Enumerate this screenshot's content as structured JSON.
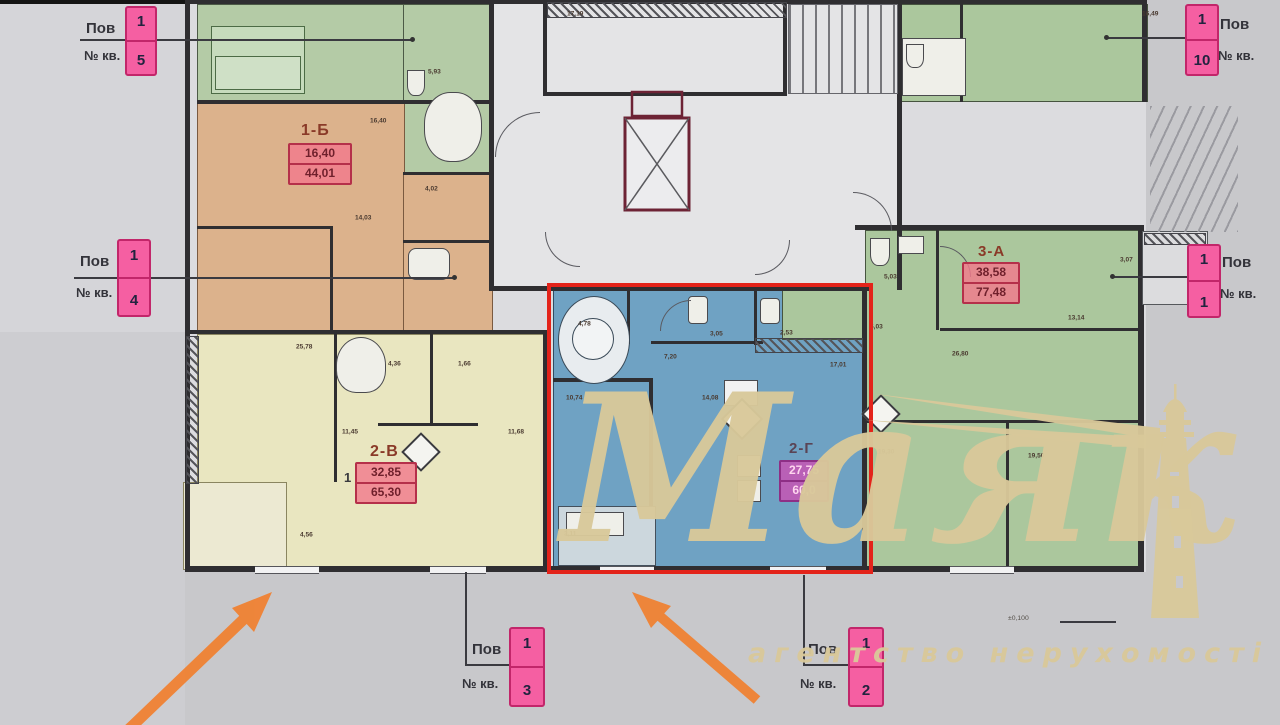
{
  "labels": {
    "pov": "Пов",
    "kv": "№ кв."
  },
  "floor_tags": [
    {
      "floor": "1",
      "apt": "5"
    },
    {
      "floor": "1",
      "apt": "4"
    },
    {
      "floor": "1",
      "apt": "10"
    },
    {
      "floor": "1",
      "apt": "1"
    },
    {
      "floor": "1",
      "apt": "3"
    },
    {
      "floor": "1",
      "apt": "2"
    }
  ],
  "apartments": [
    {
      "code": "1-Б",
      "living": "16,40",
      "total": "44,01"
    },
    {
      "code": "2-В",
      "living": "32,85",
      "total": "65,30"
    },
    {
      "code": "2-Г",
      "living": "27,75",
      "total": "60,0"
    },
    {
      "code": "3-А",
      "living": "38,58",
      "total": "77,48"
    }
  ],
  "extra": {
    "one": "1",
    "level": "±0,100"
  },
  "dims": [
    {
      "t": "17,19",
      "x": 567,
      "y": 10
    },
    {
      "t": "16,49",
      "x": 1142,
      "y": 10
    },
    {
      "t": "5,93",
      "x": 428,
      "y": 68
    },
    {
      "t": "16,40",
      "x": 370,
      "y": 117
    },
    {
      "t": "4,02",
      "x": 425,
      "y": 185
    },
    {
      "t": "14,03",
      "x": 355,
      "y": 214
    },
    {
      "t": "25,78",
      "x": 296,
      "y": 343
    },
    {
      "t": "4,36",
      "x": 388,
      "y": 360
    },
    {
      "t": "1,66",
      "x": 458,
      "y": 360
    },
    {
      "t": "11,45",
      "x": 342,
      "y": 428
    },
    {
      "t": "11,68",
      "x": 508,
      "y": 428
    },
    {
      "t": "4,56",
      "x": 300,
      "y": 531
    },
    {
      "t": "4,78",
      "x": 578,
      "y": 320
    },
    {
      "t": "7,20",
      "x": 664,
      "y": 353
    },
    {
      "t": "3,05",
      "x": 710,
      "y": 330
    },
    {
      "t": "2,53",
      "x": 780,
      "y": 329
    },
    {
      "t": "17,01",
      "x": 830,
      "y": 361
    },
    {
      "t": "10,74",
      "x": 566,
      "y": 394
    },
    {
      "t": "14,08",
      "x": 702,
      "y": 394
    },
    {
      "t": "3,11",
      "x": 564,
      "y": 530
    },
    {
      "t": "5,03",
      "x": 884,
      "y": 273
    },
    {
      "t": "6,03",
      "x": 870,
      "y": 323
    },
    {
      "t": "3,07",
      "x": 1120,
      "y": 256
    },
    {
      "t": "13,14",
      "x": 1068,
      "y": 314
    },
    {
      "t": "26,80",
      "x": 952,
      "y": 350
    },
    {
      "t": "19,30",
      "x": 878,
      "y": 448
    },
    {
      "t": "19,50",
      "x": 1028,
      "y": 452
    }
  ],
  "watermark": {
    "brand": "Маяк",
    "tagline": "агентство нерухомості"
  }
}
